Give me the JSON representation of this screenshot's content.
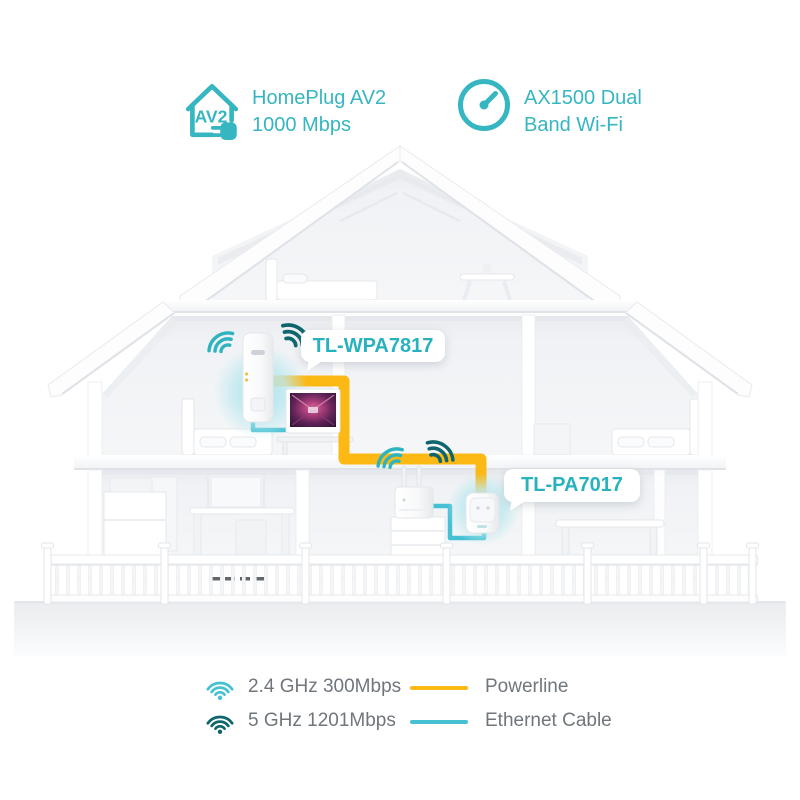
{
  "badges": [
    {
      "icon": "homeplug-av2-icon",
      "icon_text": "AV2",
      "line1": "HomePlug AV2",
      "line2": "1000 Mbps"
    },
    {
      "icon": "speed-gauge-icon",
      "line1": "AX1500 Dual",
      "line2": "Band Wi-Fi"
    }
  ],
  "devices": {
    "extender": {
      "label": "TL-WPA7817"
    },
    "adapter": {
      "label": "TL-PA7017"
    }
  },
  "legend": {
    "wifi": [
      {
        "band": "2.4 GHz 300Mbps"
      },
      {
        "band": "5 GHz 1201Mbps"
      }
    ],
    "cables": [
      {
        "name": "Powerline"
      },
      {
        "name": "Ethernet Cable"
      }
    ]
  },
  "colors": {
    "accent": "#35b6c1",
    "label": "#27b2bd",
    "wifi-light": "#2fb3bf",
    "wifi-dark": "#0e666d",
    "powerline": "#fcb813",
    "ethernet": "#45c1d3",
    "glow": "#b9e7ec"
  }
}
